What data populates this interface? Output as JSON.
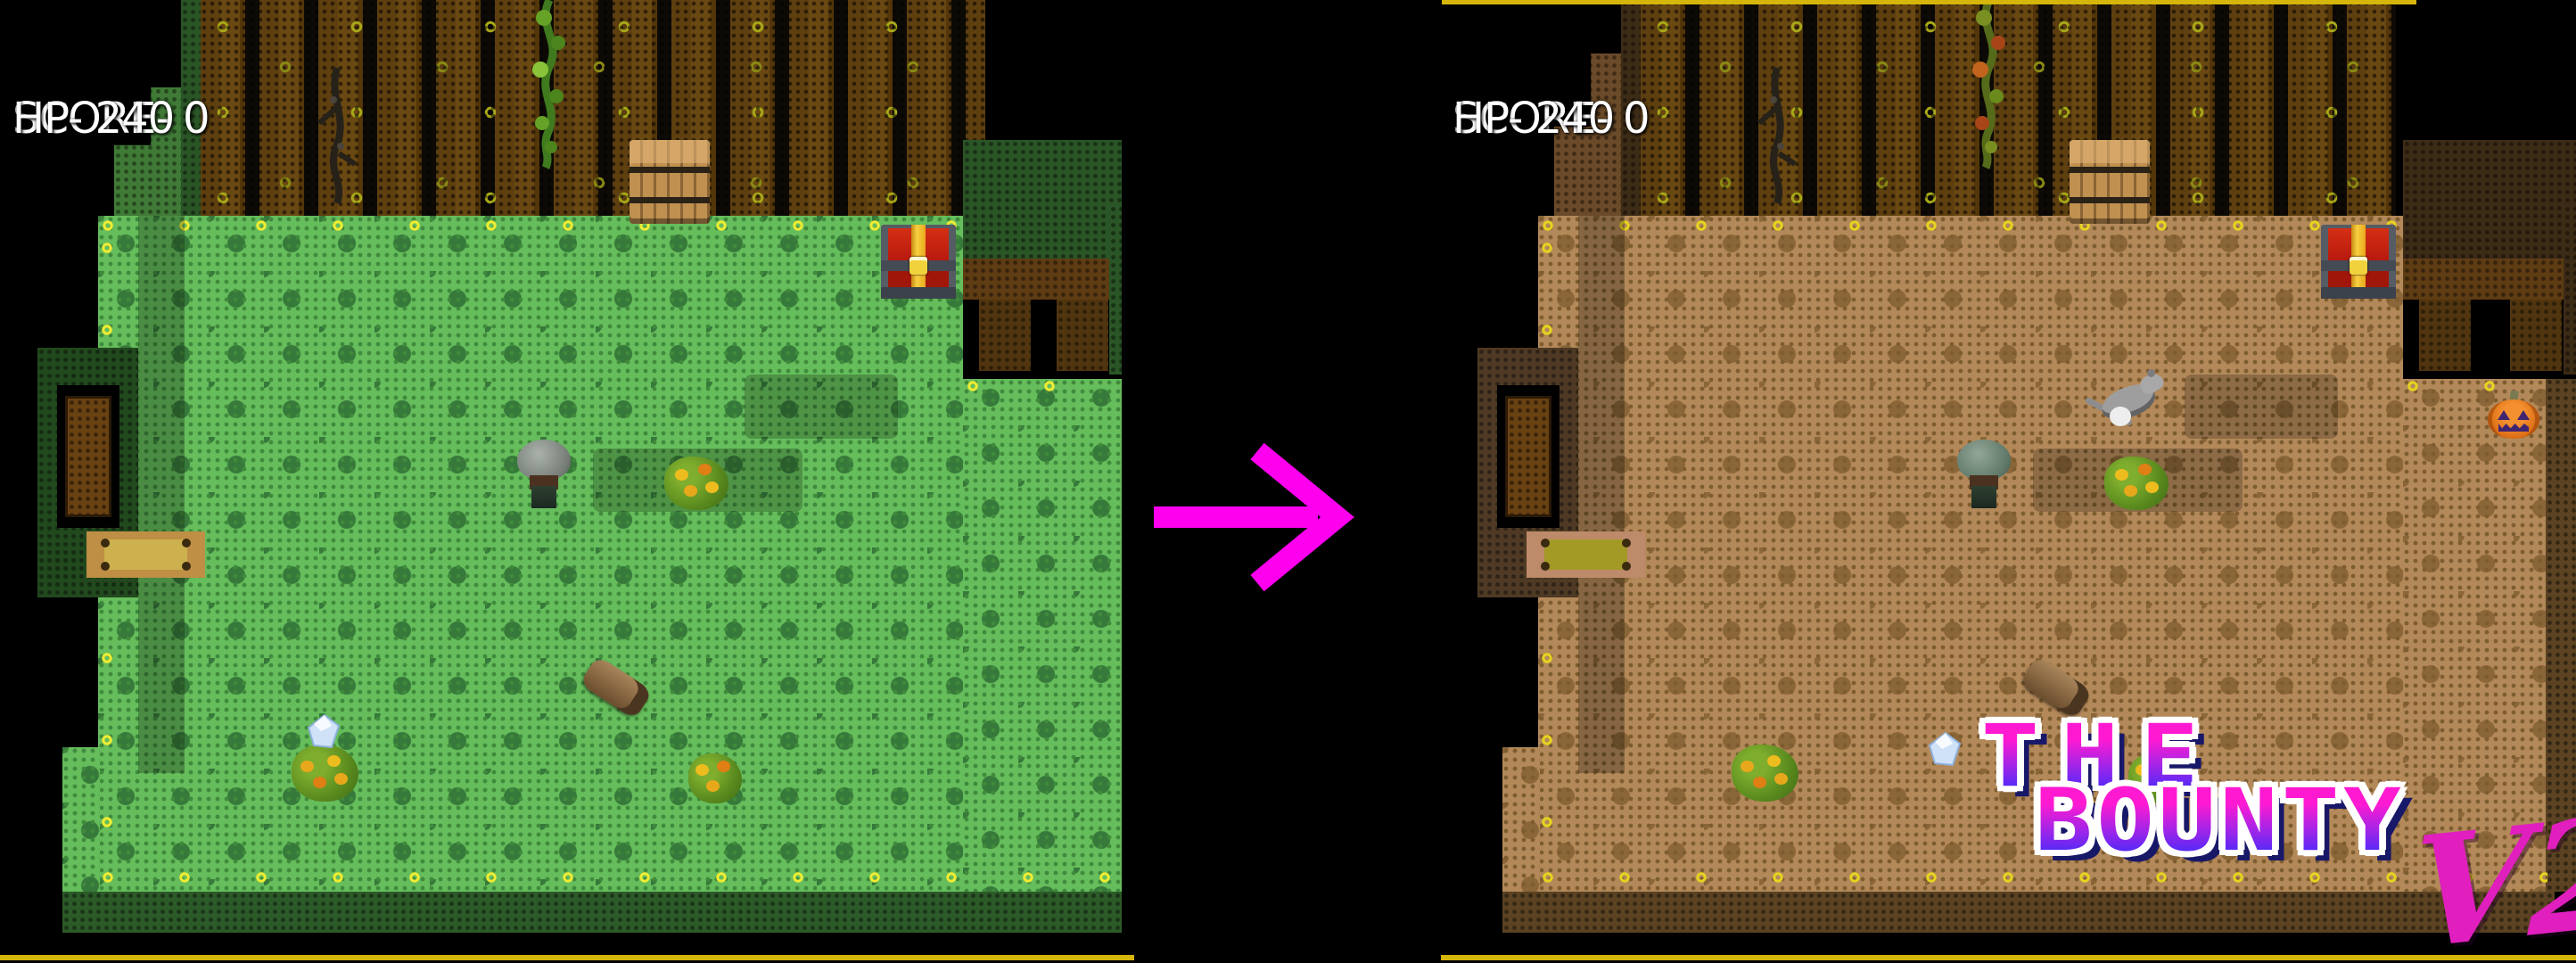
{
  "scene": {
    "description": "Before/after comparison of a top-down pixel RPG room: original green version transforms into autumn-brown V2"
  },
  "left_panel": {
    "theme": "grass-green original",
    "hud": {
      "score": "SCORE- 0",
      "hp": "HP- 240"
    },
    "sprites": [
      "player-character",
      "flower-bush",
      "crystal-gem",
      "log",
      "treasure-chest",
      "barrel",
      "vine",
      "dead-branch",
      "door",
      "door-mat"
    ]
  },
  "right_panel": {
    "theme": "autumn-brown V2",
    "hud": {
      "score": "SCORE- 0",
      "hp": "HP- 240"
    },
    "logo": {
      "line1": "THE",
      "line2": "BOUNTY",
      "version": "V2"
    },
    "sprites": [
      "player-character",
      "rat-enemy",
      "pumpkin",
      "flower-bush",
      "crystal-gem",
      "log",
      "treasure-chest",
      "barrel",
      "autumn-vine",
      "dead-branch",
      "door",
      "door-mat"
    ]
  },
  "palette": {
    "left_floor": "#66bd5c",
    "left_floor_dot": "#3f8a3b",
    "left_floor_motif": "#36793a",
    "right_floor": "#b4895a",
    "right_floor_dot": "#7d5c30",
    "right_floor_motif": "#8a6638",
    "hud_text": "#ffffff",
    "arrow": "#ff00ef",
    "logo_top": "#ff1ad1",
    "logo_bottom": "#2b2bff",
    "logo_outline": "#ffffff",
    "v2_color": "#e01fbe",
    "accent_line": "#d6b60a"
  }
}
